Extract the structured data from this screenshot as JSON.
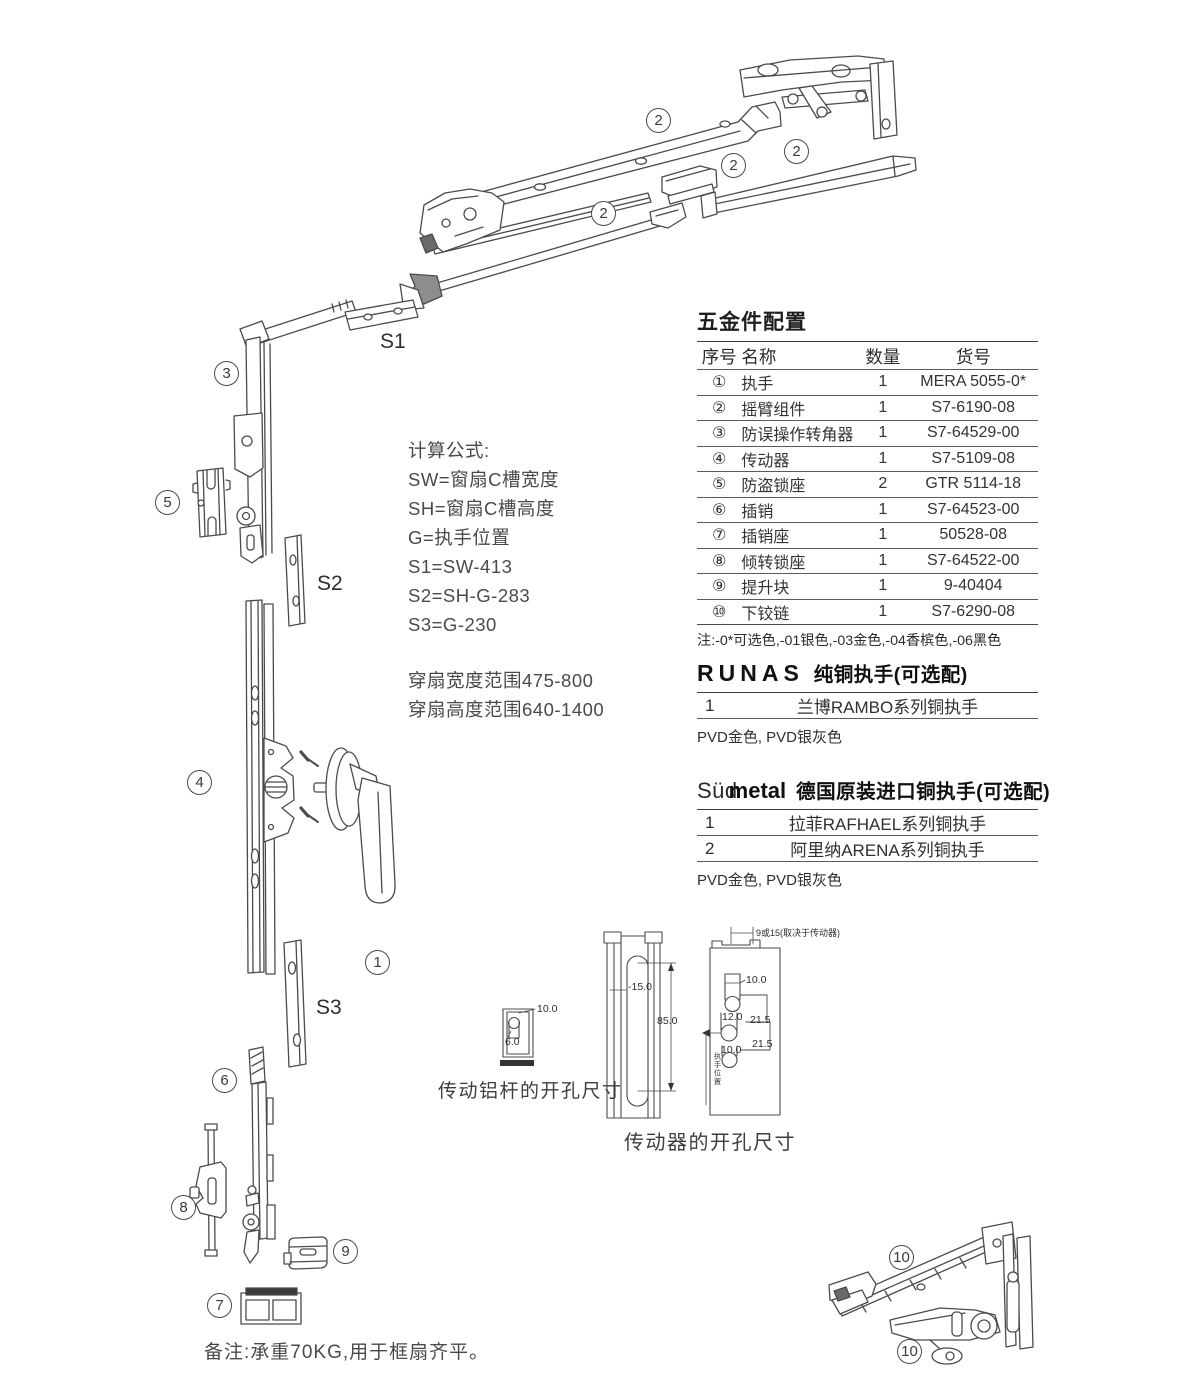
{
  "page": {
    "background": "#ffffff",
    "line_color": "#4b4b4b"
  },
  "hardware_table": {
    "title": "五金件配置",
    "headers": [
      "序号",
      "名称",
      "数量",
      "货号"
    ],
    "rows": [
      {
        "no": "①",
        "name": "执手",
        "qty": "1",
        "code": "MERA 5055-0*"
      },
      {
        "no": "②",
        "name": "摇臂组件",
        "qty": "1",
        "code": "S7-6190-08"
      },
      {
        "no": "③",
        "name": "防误操作转角器",
        "qty": "1",
        "code": "S7-64529-00"
      },
      {
        "no": "④",
        "name": "传动器",
        "qty": "1",
        "code": "S7-5109-08"
      },
      {
        "no": "⑤",
        "name": "防盗锁座",
        "qty": "2",
        "code": "GTR 5114-18"
      },
      {
        "no": "⑥",
        "name": "插销",
        "qty": "1",
        "code": "S7-64523-00"
      },
      {
        "no": "⑦",
        "name": "插销座",
        "qty": "1",
        "code": "50528-08"
      },
      {
        "no": "⑧",
        "name": "倾转锁座",
        "qty": "1",
        "code": "S7-64522-00"
      },
      {
        "no": "⑨",
        "name": "提升块",
        "qty": "1",
        "code": "9-40404"
      },
      {
        "no": "⑩",
        "name": "下铰链",
        "qty": "1",
        "code": "S7-6290-08"
      }
    ],
    "note": "注:-0*可选色,-01银色,-03金色,-04香槟色,-06黑色"
  },
  "runas_section": {
    "brand": "RUNAS",
    "title": "纯铜执手(可选配)",
    "rows": [
      {
        "no": "1",
        "name": "兰博RAMBO系列铜执手"
      }
    ],
    "note": "PVD金色, PVD银灰色"
  },
  "sudmetal_section": {
    "brand_light": "Süd",
    "brand_bold": "metal",
    "title": "德国原装进口铜执手(可选配)",
    "rows": [
      {
        "no": "1",
        "name": "拉菲RAFHAEL系列铜执手"
      },
      {
        "no": "2",
        "name": "阿里纳ARENA系列铜执手"
      }
    ],
    "note": "PVD金色, PVD银灰色"
  },
  "formulas": {
    "title": "计算公式:",
    "lines": [
      "SW=窗扇C槽宽度",
      "SH=窗扇C槽高度",
      "G=执手位置",
      "S1=SW-413",
      "S2=SH-G-283",
      "S3=G-230"
    ]
  },
  "ranges": {
    "lines": [
      "穿扇宽度范围475-800",
      "穿扇高度范围640-1400"
    ]
  },
  "callouts": [
    {
      "text": "2"
    },
    {
      "text": "2"
    },
    {
      "text": "2"
    },
    {
      "text": "2"
    },
    {
      "text": "3"
    },
    {
      "text": "5"
    },
    {
      "text": "4"
    },
    {
      "text": "1"
    },
    {
      "text": "6"
    },
    {
      "text": "8"
    },
    {
      "text": "9"
    },
    {
      "text": "7"
    },
    {
      "text": "10"
    },
    {
      "text": "10"
    }
  ],
  "s_labels": [
    {
      "text": "S1"
    },
    {
      "text": "S2"
    },
    {
      "text": "S3"
    }
  ],
  "dim_drawings": {
    "alu_rod_label": "传动铝杆的开孔尺寸",
    "gearbox_label": "传动器的开孔尺寸",
    "dims": {
      "alu_w": "10.0",
      "alu_h": "6.0",
      "slot_offset": "-15.0",
      "slot_len": "85.0",
      "face_top": "9或15(取决于传动器)",
      "face_h1": "10.0",
      "face_h2": "12.0",
      "face_g1": "21.5",
      "face_h3": "10.0",
      "face_g2": "21.5",
      "face_vertical": "执手位置"
    }
  },
  "footer_note": "备注:承重70KG,用于框扇齐平。"
}
